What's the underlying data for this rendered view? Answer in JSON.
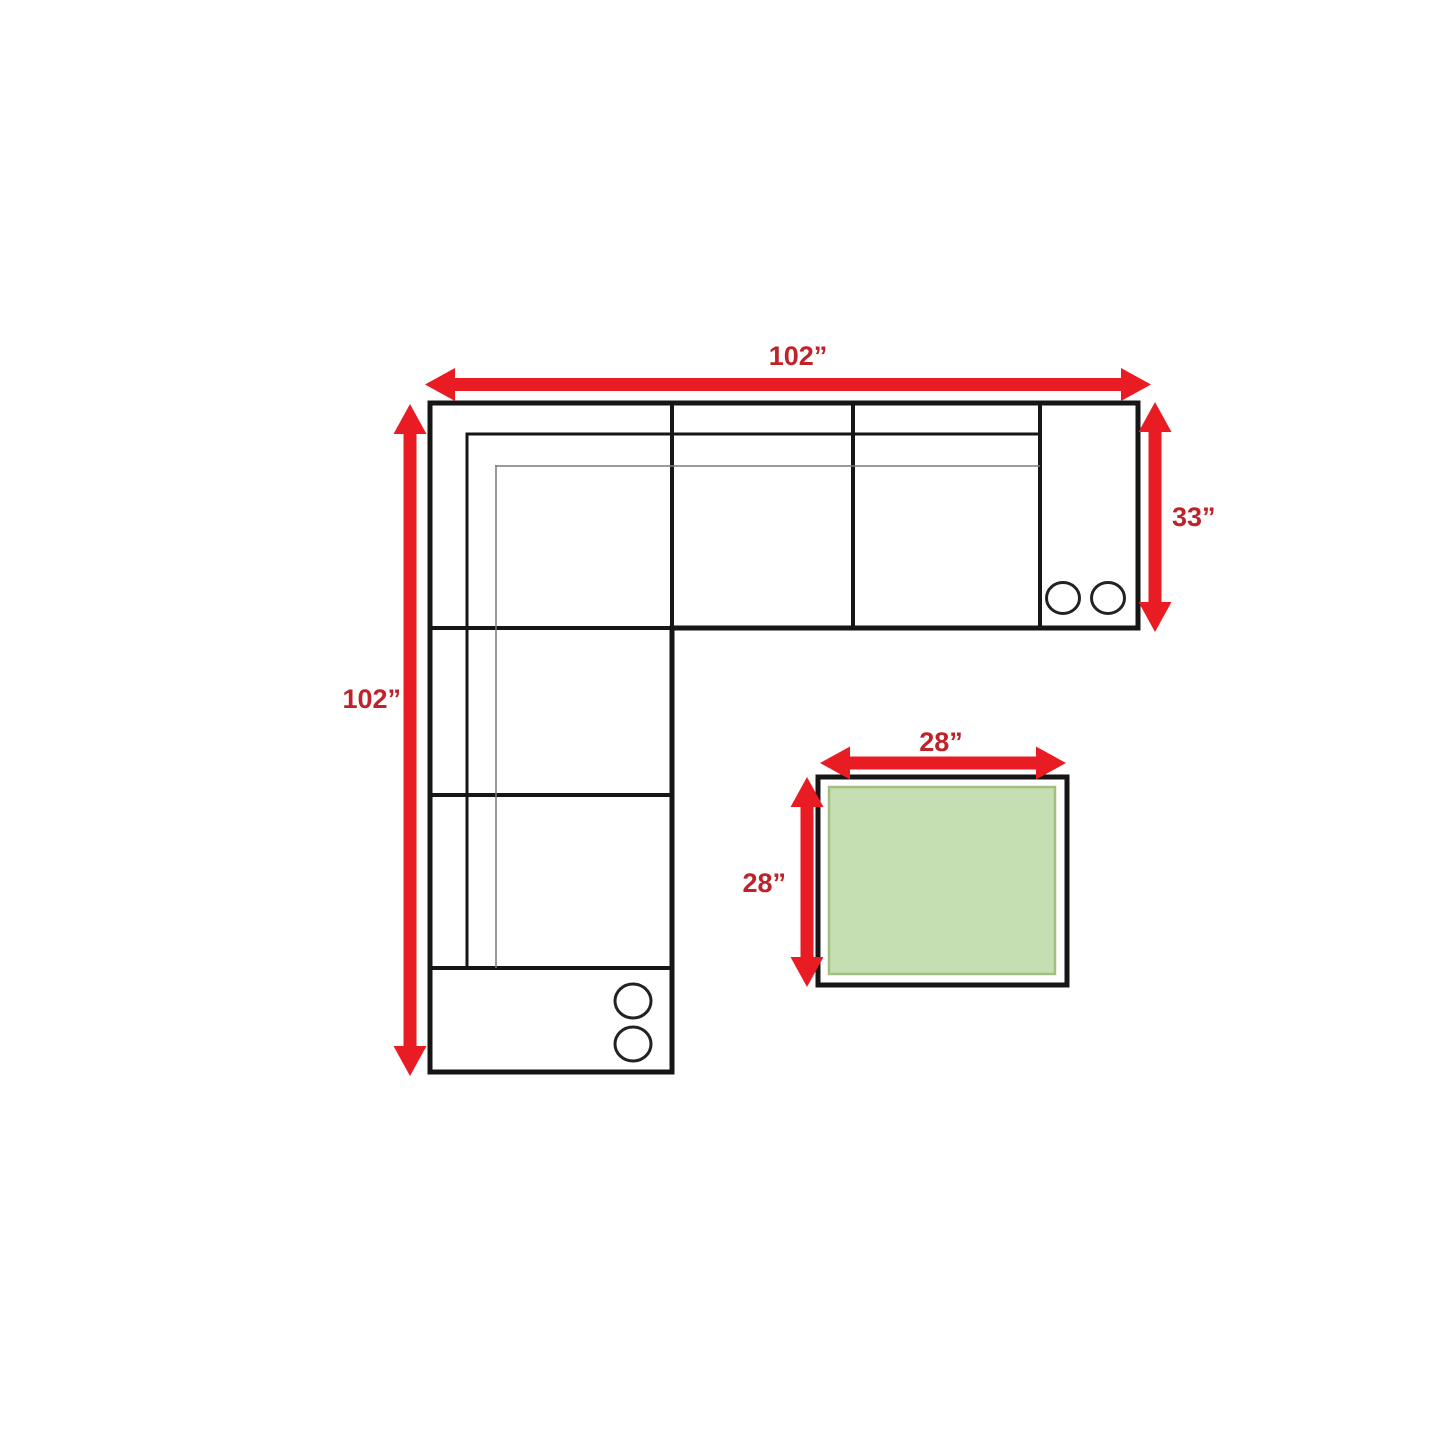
{
  "diagram": {
    "type": "furniture-floor-plan",
    "items": {
      "sectional_sofa": {
        "shape": "L-shaped sectional, top view",
        "width_label": "102”",
        "depth_label": "102”",
        "section_depth_label": "33”",
        "cupholders_top_right": 2,
        "cupholders_bottom_console": 2
      },
      "ottoman": {
        "shape": "square, top view",
        "width_label": "28”",
        "depth_label": "28”"
      }
    }
  },
  "labels": {
    "sofa_width": "102”",
    "sofa_depth": "102”",
    "section_depth": "33”",
    "ottoman_width": "28”",
    "ottoman_depth": "28”"
  },
  "colors": {
    "arrow_red": "#ea1c23",
    "label_red": "#bf2228",
    "outline_black": "#161616",
    "seam_gray": "#7a7a7a",
    "ottoman_fill": "#c5deb2",
    "ottoman_border": "#a0c07f",
    "background": "#ffffff"
  }
}
